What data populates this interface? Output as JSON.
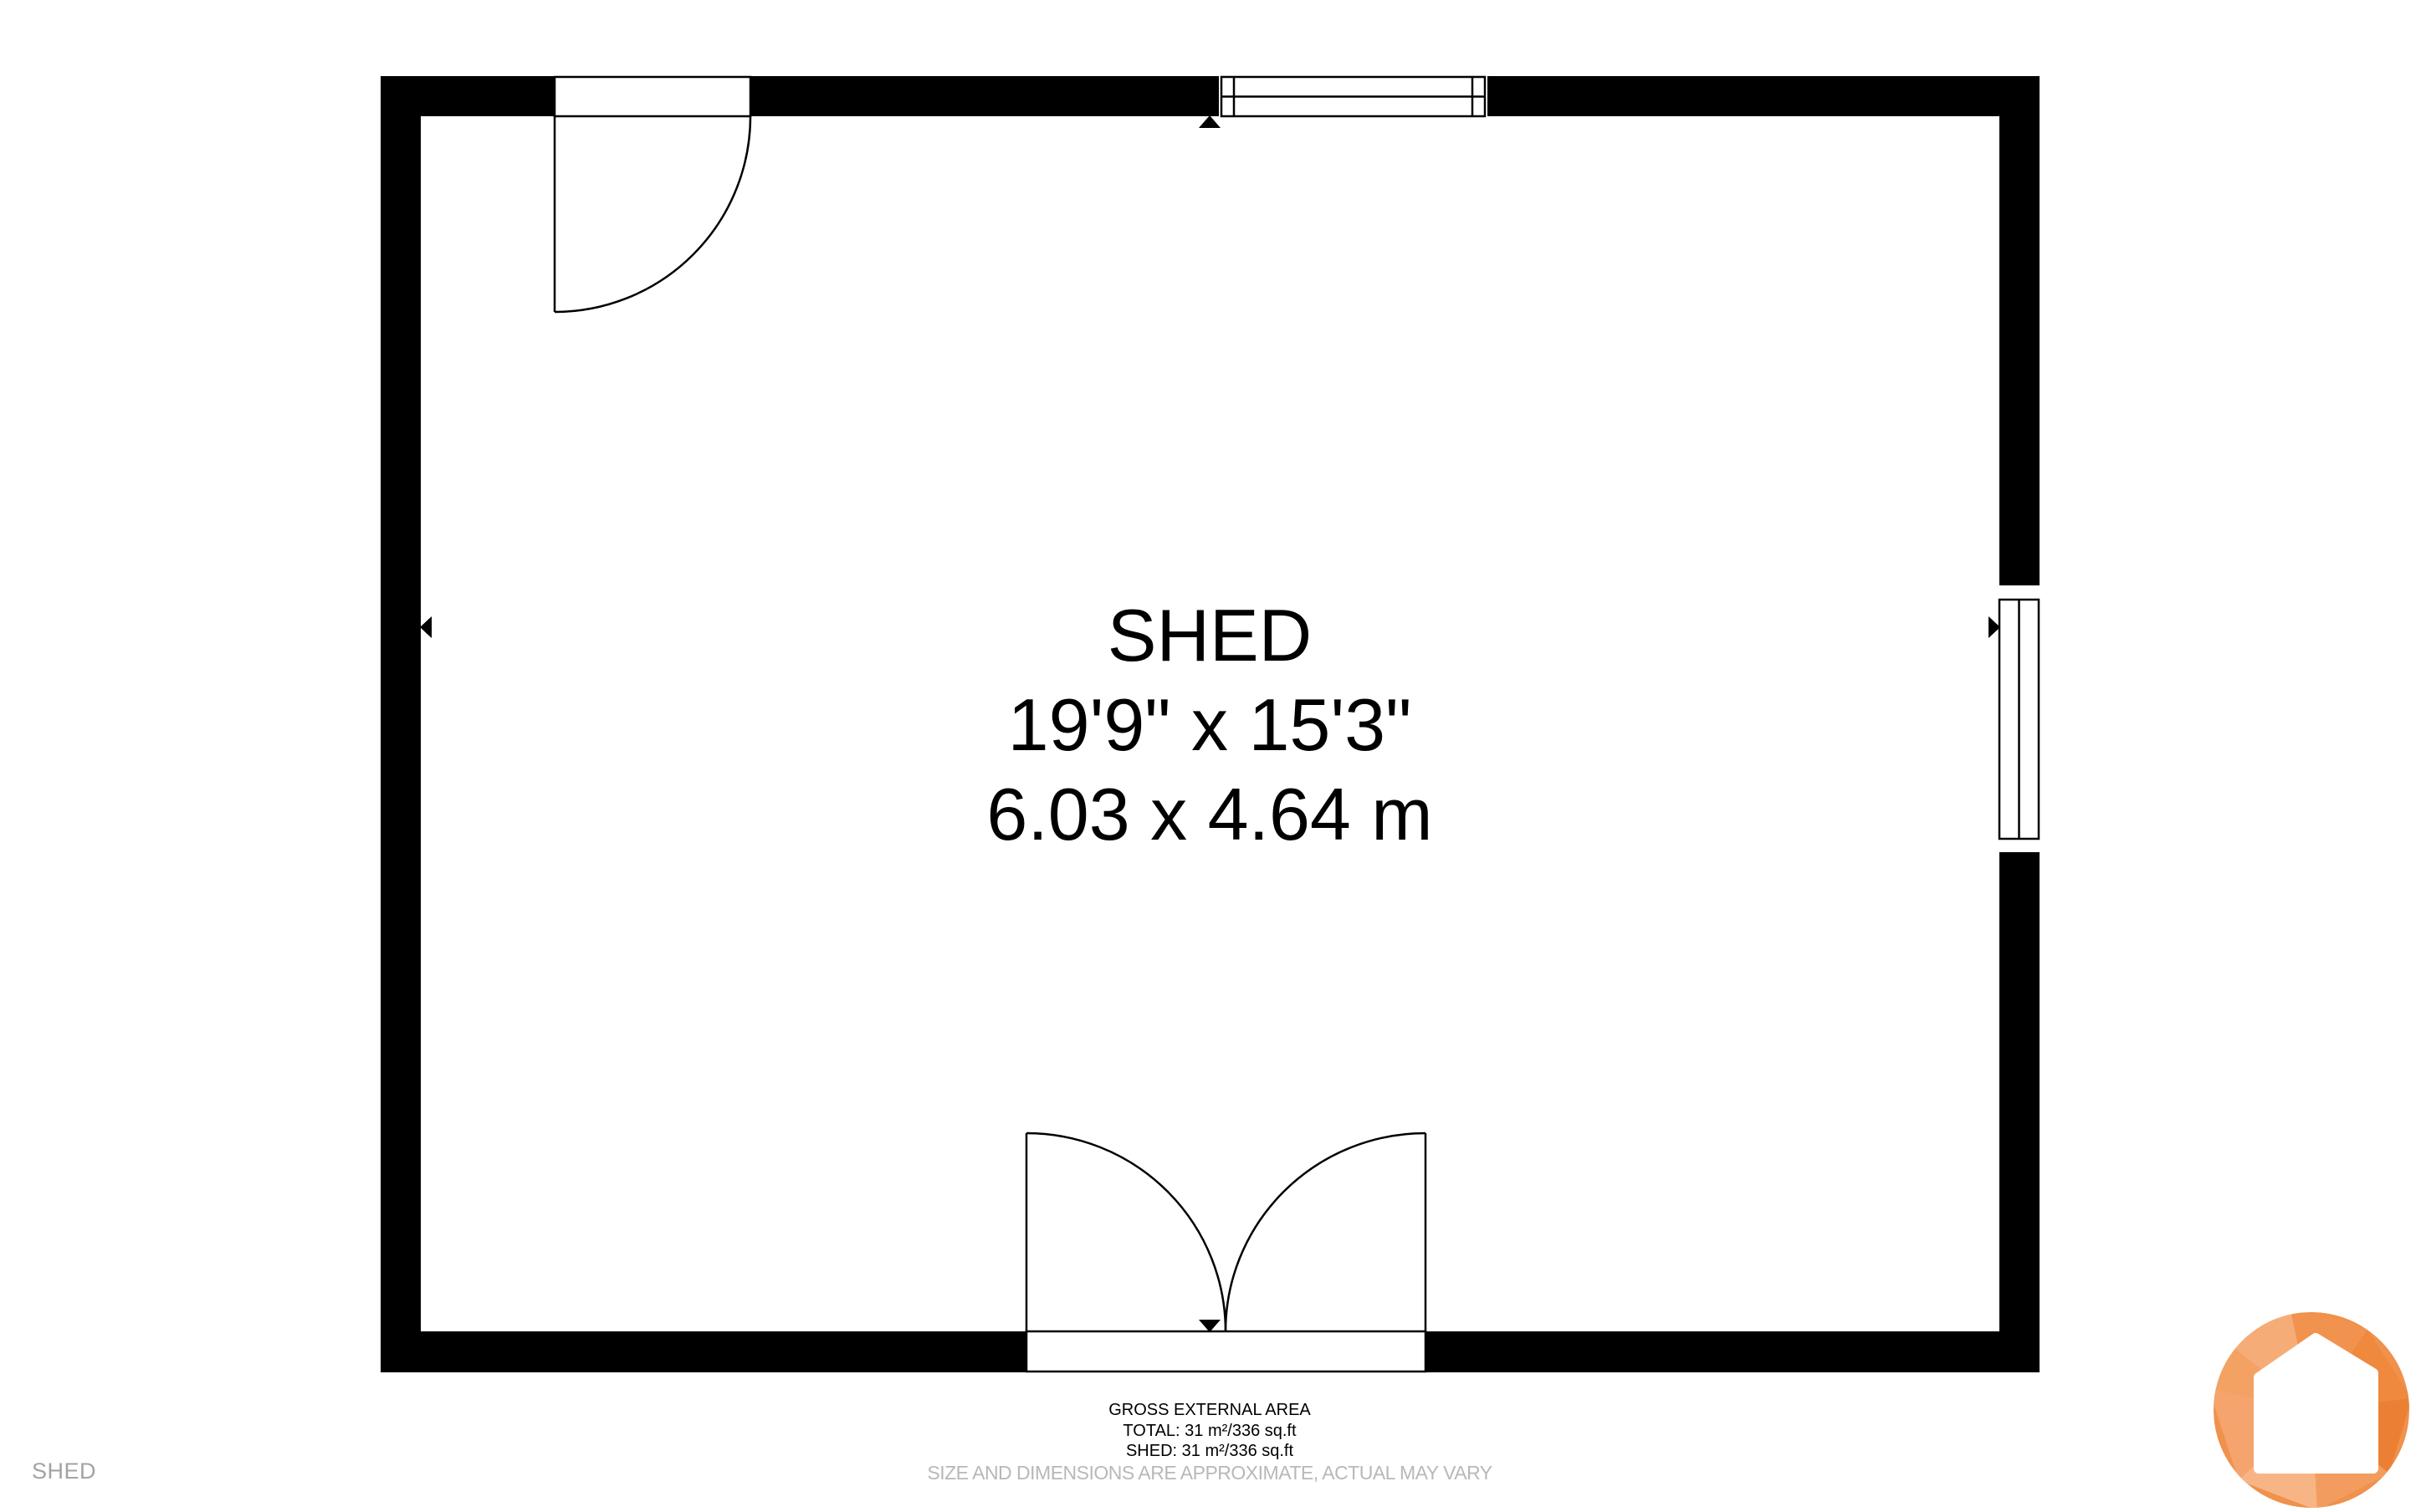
{
  "plan": {
    "room_label": {
      "name": "SHED",
      "imperial": "19'9\" x 15'3\"",
      "metric": "6.03 x 4.64 m"
    }
  },
  "footer": {
    "area_title": "GROSS EXTERNAL AREA",
    "area_total": "TOTAL: 31 m²/336 sq.ft",
    "area_shed": "SHED: 31 m²/336 sq.ft",
    "disclaimer": "SIZE AND DIMENSIONS ARE APPROXIMATE, ACTUAL MAY VARY"
  },
  "watermark": {
    "label": "SHED"
  },
  "colors": {
    "wall-color": "#000000",
    "disclaimer-color": "#b8b8b8",
    "watermark-color": "#a3a3a3",
    "logo-base": "#f0914c",
    "logo-dark": "#eb8034",
    "logo-light": "#f7b585"
  }
}
